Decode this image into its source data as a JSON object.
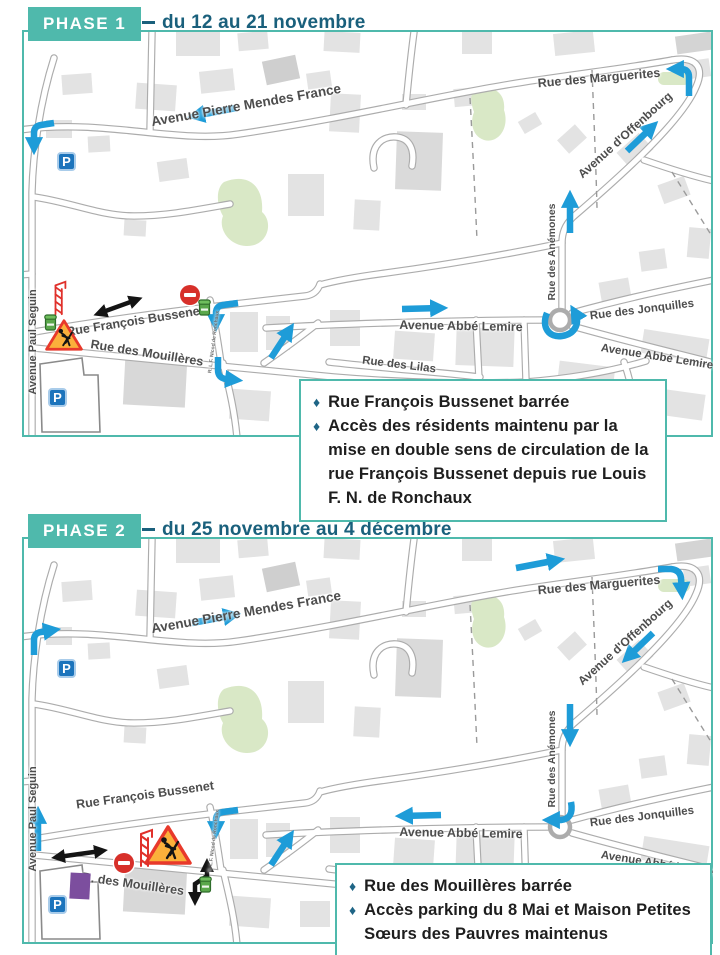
{
  "ui": {
    "bullet": "♦"
  },
  "colors": {
    "teal_accent": "#4FB9AC",
    "title_blue": "#1A607C",
    "arrow_blue": "#1E9CD8",
    "no_entry_red": "#D7302A",
    "work_sign_fill": "#FBB03B",
    "work_sign_border": "#E8392B",
    "parking_blue": "#1C74BC",
    "container_green": "#5AA74B",
    "building_purple": "#7C4E9E"
  },
  "phase1": {
    "badge": "PHASE 1",
    "title": "du 12 au 21 novembre",
    "notes": [
      "Rue François Bussenet barrée",
      "Accès des résidents maintenu par la mise en double sens de circulation de la rue François Bussenet depuis rue Louis F. N. de Ronchaux"
    ]
  },
  "phase2": {
    "badge": "PHASE 2",
    "title": "du 25 novembre au 4 décembre",
    "notes": [
      "Rue des Mouillères barrée",
      "Accès parking du 8 Mai et Maison Petites Sœurs des Pauvres maintenus"
    ]
  },
  "map": {
    "parking_letter": "P",
    "streets": {
      "pmf": "Avenue Pierre Mendes France",
      "marguerites": "Rue des Marguerites",
      "offenbourg": "Avenue d'Offenbourg",
      "anemones": "Rue des Anémones",
      "lemire_west": "Avenue Abbé Lemire",
      "lemire_east": "Avenue Abbé Lemire",
      "jonquilles": "Rue des Jonquilles",
      "lilas": "Rue des Lilas",
      "bussenet": "Rue François Bussenet",
      "mouilleres": "Rue des Mouillères",
      "mouilleres_short": "R. des Mouillères",
      "seguin": "Avenue Paul Seguin",
      "ronchaux": "R. L.F. Nicod de Ronchaux"
    }
  }
}
